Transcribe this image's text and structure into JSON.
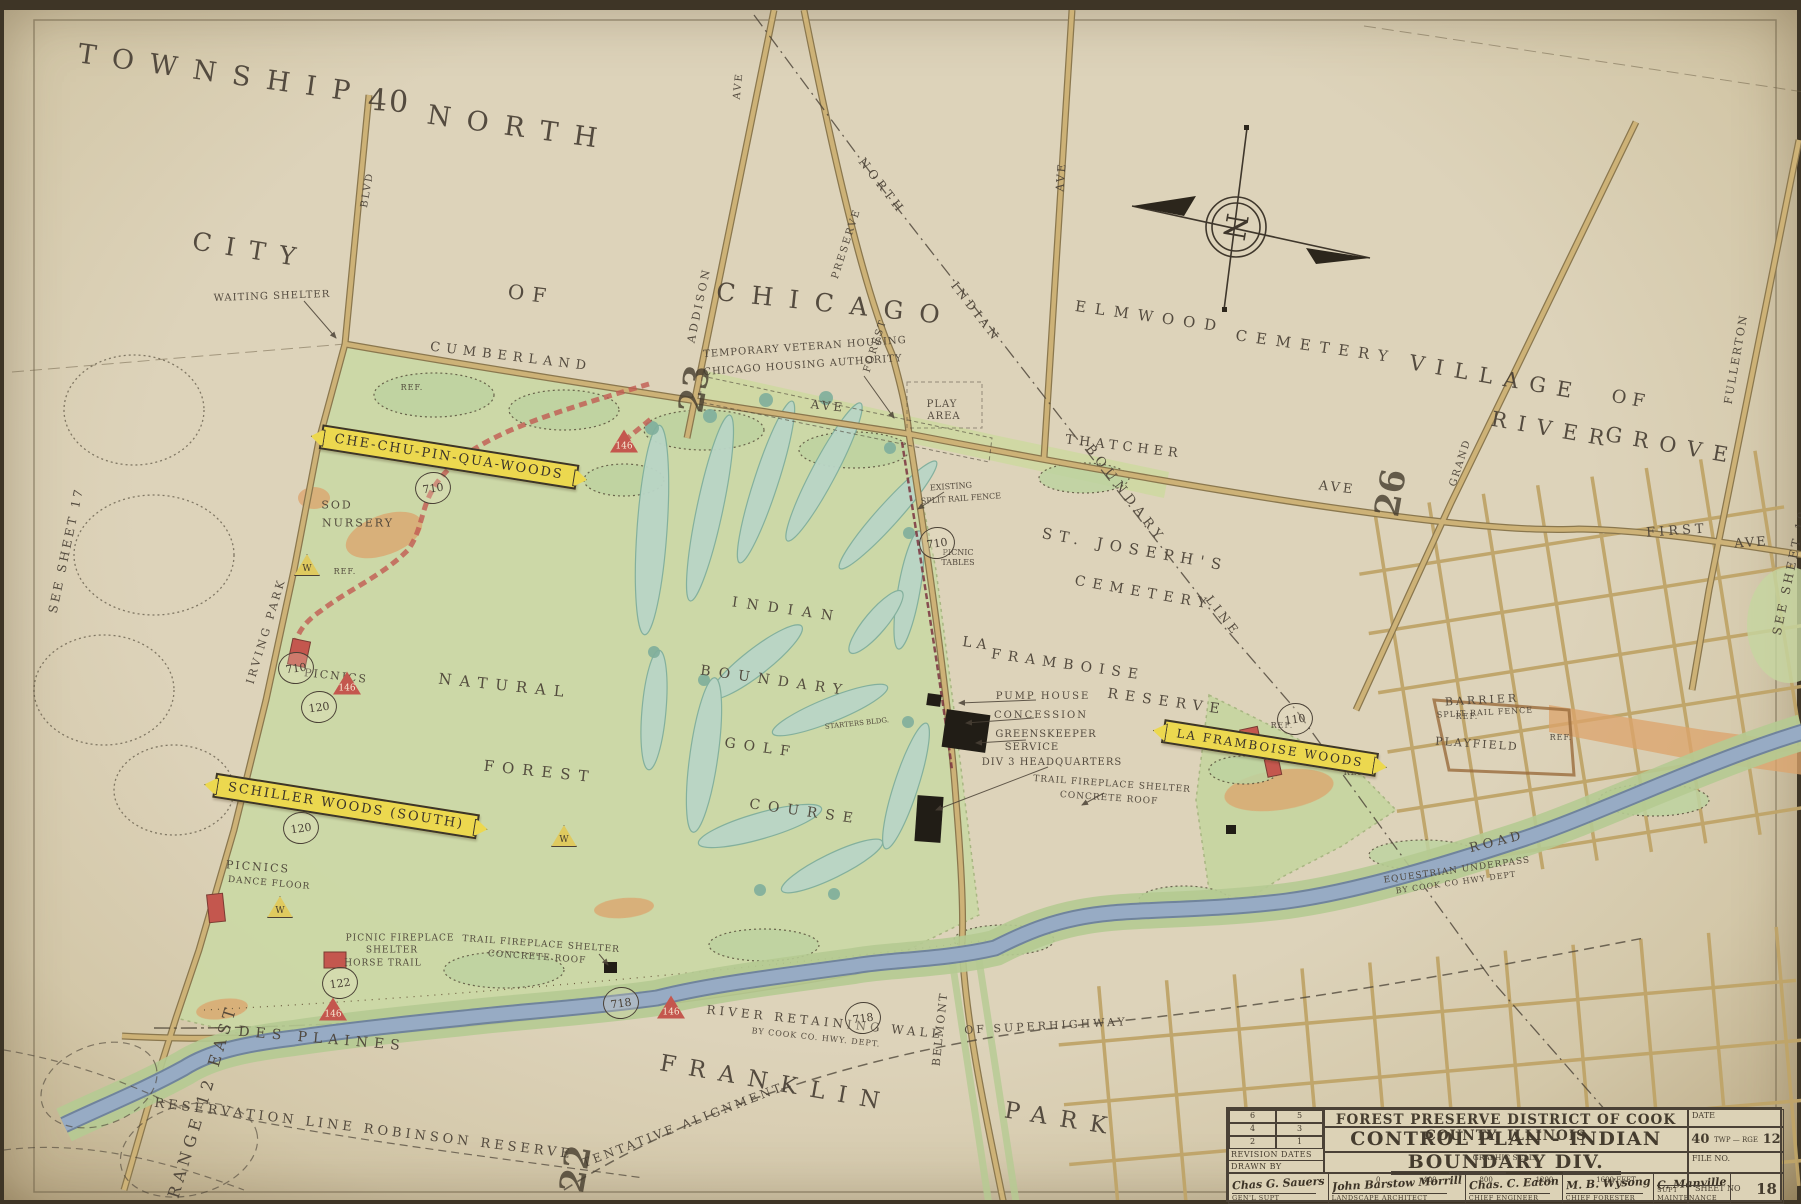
{
  "colors": {
    "paper": "#ddd3ba",
    "ink": "#4a4136",
    "road": "#c9ae74",
    "roadEdge": "#8a774e",
    "green": "#c8d8a4",
    "golf": "#b9d5c6",
    "river": "#97abc4",
    "banner": "#ecd84f",
    "red": "#c4574e",
    "trail": "#c25b52",
    "orange": "#dca36b"
  },
  "compass": {
    "letter": "N"
  },
  "banners": [
    {
      "t": "CHE-CHU-PIN-QUA-WOODS",
      "x": 445,
      "y": 447,
      "r": 9,
      "s": 13
    },
    {
      "t": "SCHILLER WOODS (SOUTH)",
      "x": 342,
      "y": 796,
      "r": 9,
      "s": 13
    },
    {
      "t": "LA FRAMBOISE WOODS",
      "x": 1266,
      "y": 738,
      "r": 9,
      "s": 12
    }
  ],
  "circles": [
    {
      "n": "710",
      "x": 429,
      "y": 478
    },
    {
      "n": "710",
      "x": 933,
      "y": 533
    },
    {
      "n": "710",
      "x": 292,
      "y": 658
    },
    {
      "n": "120",
      "x": 315,
      "y": 697
    },
    {
      "n": "120",
      "x": 297,
      "y": 818
    },
    {
      "n": "122",
      "x": 336,
      "y": 973
    },
    {
      "n": "718",
      "x": 617,
      "y": 993
    },
    {
      "n": "718",
      "x": 859,
      "y": 1008
    },
    {
      "n": "110",
      "x": 1291,
      "y": 709
    }
  ],
  "triangles": [
    {
      "n": "146",
      "x": 620,
      "y": 431,
      "k": "red"
    },
    {
      "n": "146",
      "x": 343,
      "y": 673,
      "k": "red"
    },
    {
      "n": "146",
      "x": 667,
      "y": 997,
      "k": "red"
    },
    {
      "n": "146",
      "x": 329,
      "y": 999,
      "k": "red"
    },
    {
      "n": "W",
      "x": 303,
      "y": 555,
      "k": "yel"
    },
    {
      "n": "W",
      "x": 276,
      "y": 897,
      "k": "yel"
    },
    {
      "n": "W",
      "x": 560,
      "y": 826,
      "k": "yel"
    }
  ],
  "labels": [
    {
      "t": "TOWNSHIP",
      "x": 218,
      "y": 64,
      "r": 8,
      "s": 27,
      "ls": 16
    },
    {
      "t": "40",
      "x": 385,
      "y": 92,
      "r": 4,
      "s": 30,
      "ls": 2
    },
    {
      "t": "NORTH",
      "x": 516,
      "y": 118,
      "r": 8,
      "s": 27,
      "ls": 16
    },
    {
      "t": "CITY",
      "x": 247,
      "y": 240,
      "r": 9,
      "s": 25,
      "ls": 14
    },
    {
      "t": "OF",
      "x": 527,
      "y": 284,
      "r": 7,
      "s": 20,
      "ls": 8
    },
    {
      "t": "CHICAGO",
      "x": 832,
      "y": 294,
      "r": 6,
      "s": 25,
      "ls": 16
    },
    {
      "t": "VILLAGE",
      "x": 1492,
      "y": 368,
      "r": 10,
      "s": 21,
      "ls": 11
    },
    {
      "t": "OF",
      "x": 1627,
      "y": 390,
      "r": 10,
      "s": 18,
      "ls": 6
    },
    {
      "t": "RIVER",
      "x": 1549,
      "y": 420,
      "r": 10,
      "s": 21,
      "ls": 11
    },
    {
      "t": "GROVE",
      "x": 1668,
      "y": 436,
      "r": 10,
      "s": 21,
      "ls": 11
    },
    {
      "t": "ELMWOOD",
      "x": 1146,
      "y": 307,
      "r": 8,
      "s": 15,
      "ls": 9
    },
    {
      "t": "CEMETERY",
      "x": 1312,
      "y": 337,
      "r": 8,
      "s": 15,
      "ls": 9
    },
    {
      "t": "FRANKLIN",
      "x": 772,
      "y": 1074,
      "r": 10,
      "s": 23,
      "ls": 13
    },
    {
      "t": "PARK",
      "x": 1058,
      "y": 1110,
      "r": 9,
      "s": 23,
      "ls": 13
    },
    {
      "t": "ST. JOSEPH'S",
      "x": 1131,
      "y": 540,
      "r": 10,
      "s": 15,
      "ls": 7
    },
    {
      "t": "CEMETERY",
      "x": 1140,
      "y": 583,
      "r": 10,
      "s": 14,
      "ls": 7
    },
    {
      "t": "BOUNDARY",
      "x": 1121,
      "y": 484,
      "r": 52,
      "s": 13,
      "ls": 5
    },
    {
      "t": "LINE",
      "x": 1219,
      "y": 606,
      "r": 52,
      "s": 12,
      "ls": 4
    },
    {
      "t": "LA",
      "x": 973,
      "y": 634,
      "r": 8,
      "s": 14,
      "ls": 5
    },
    {
      "t": "FRAMBOISE",
      "x": 1064,
      "y": 655,
      "r": 8,
      "s": 14,
      "ls": 7
    },
    {
      "t": "RESERVE",
      "x": 1163,
      "y": 692,
      "r": 8,
      "s": 14,
      "ls": 7
    },
    {
      "t": "NATURAL",
      "x": 501,
      "y": 676,
      "r": 6,
      "s": 15,
      "ls": 8
    },
    {
      "t": "FOREST",
      "x": 536,
      "y": 762,
      "r": 6,
      "s": 15,
      "ls": 8
    },
    {
      "t": "INDIAN",
      "x": 783,
      "y": 600,
      "r": 8,
      "s": 14,
      "ls": 9
    },
    {
      "t": "BOUNDARY",
      "x": 771,
      "y": 671,
      "r": 8,
      "s": 14,
      "ls": 8
    },
    {
      "t": "GOLF",
      "x": 757,
      "y": 738,
      "r": 8,
      "s": 14,
      "ls": 8
    },
    {
      "t": "COURSE",
      "x": 801,
      "y": 802,
      "r": 8,
      "s": 14,
      "ls": 8
    },
    {
      "t": "DES PLAINES",
      "x": 318,
      "y": 1029,
      "r": 5,
      "s": 14,
      "ls": 6
    },
    {
      "t": "RANGE 12 EAST",
      "x": 199,
      "y": 1091,
      "r": -73,
      "s": 16,
      "ls": 5
    },
    {
      "t": "RESERVATION LINE ROBINSON RESERVE",
      "x": 360,
      "y": 1119,
      "r": 7,
      "s": 13,
      "ls": 4
    },
    {
      "t": "NORTH",
      "x": 878,
      "y": 176,
      "r": 52,
      "s": 12,
      "ls": 4
    },
    {
      "t": "INDIAN",
      "x": 972,
      "y": 302,
      "r": 52,
      "s": 12,
      "ls": 4
    },
    {
      "t": "CUMBERLAND",
      "x": 507,
      "y": 347,
      "r": 7,
      "s": 13,
      "ls": 6
    },
    {
      "t": "AVE",
      "x": 824,
      "y": 396,
      "r": 6,
      "s": 12,
      "ls": 3
    },
    {
      "t": "THATCHER",
      "x": 1120,
      "y": 437,
      "r": 7,
      "s": 13,
      "ls": 5
    },
    {
      "t": "AVE",
      "x": 1333,
      "y": 478,
      "r": 7,
      "s": 13,
      "ls": 3
    },
    {
      "t": "ADDISON",
      "x": 695,
      "y": 295,
      "r": -78,
      "s": 11,
      "ls": 3
    },
    {
      "t": "AVE",
      "x": 735,
      "y": 76,
      "r": -84,
      "s": 10,
      "ls": 2
    },
    {
      "t": "BLVD",
      "x": 364,
      "y": 180,
      "r": -80,
      "s": 10,
      "ls": 2
    },
    {
      "t": "AVE",
      "x": 1057,
      "y": 167,
      "r": -85,
      "s": 11,
      "ls": 2
    },
    {
      "t": "PRESERVE",
      "x": 843,
      "y": 234,
      "r": -72,
      "s": 10,
      "ls": 2
    },
    {
      "t": "FOREST",
      "x": 872,
      "y": 336,
      "r": -72,
      "s": 10,
      "ls": 2
    },
    {
      "t": "IRVING PARK",
      "x": 262,
      "y": 621,
      "r": -73,
      "s": 11,
      "ls": 3
    },
    {
      "t": "GRAND",
      "x": 1457,
      "y": 453,
      "r": -72,
      "s": 10,
      "ls": 2
    },
    {
      "t": "FULLERTON",
      "x": 1732,
      "y": 349,
      "r": -80,
      "s": 11,
      "ls": 2
    },
    {
      "t": "FIRST",
      "x": 1673,
      "y": 521,
      "r": -4,
      "s": 13,
      "ls": 4
    },
    {
      "t": "AVE",
      "x": 1747,
      "y": 533,
      "r": -4,
      "s": 13,
      "ls": 2
    },
    {
      "t": "BELMONT",
      "x": 936,
      "y": 1019,
      "r": -84,
      "s": 11,
      "ls": 2
    },
    {
      "t": "ROAD",
      "x": 1493,
      "y": 832,
      "r": -14,
      "s": 13,
      "ls": 4
    },
    {
      "t": "OF SUPERHIGHWAY",
      "x": 1042,
      "y": 1016,
      "r": -3,
      "s": 11,
      "ls": 3
    },
    {
      "t": "TENTATIVE ALIGNMENT",
      "x": 679,
      "y": 1115,
      "r": -21,
      "s": 12,
      "ls": 3
    },
    {
      "t": "RIVER RETAINING WALL",
      "x": 821,
      "y": 1012,
      "r": 6,
      "s": 12,
      "ls": 4
    },
    {
      "t": "BY COOK CO. HWY. DEPT.",
      "x": 812,
      "y": 1028,
      "r": 6,
      "s": 8,
      "ls": 1
    },
    {
      "t": "EQUESTRIAN UNDERPASS",
      "x": 1453,
      "y": 861,
      "r": -8,
      "s": 9,
      "ls": 1
    },
    {
      "t": "BY COOK CO HWY DEPT",
      "x": 1452,
      "y": 873,
      "r": -8,
      "s": 8,
      "ls": 1
    },
    {
      "t": "WAITING SHELTER",
      "x": 268,
      "y": 287,
      "r": -2,
      "s": 10,
      "ls": 1
    },
    {
      "t": "TEMPORARY VETERAN HOUSING",
      "x": 801,
      "y": 338,
      "r": -4,
      "s": 10,
      "ls": 1
    },
    {
      "t": "CHICAGO HOUSING AUTHORITY",
      "x": 799,
      "y": 356,
      "r": -4,
      "s": 10,
      "ls": 1
    },
    {
      "t": "PLAY",
      "x": 938,
      "y": 395,
      "r": 0,
      "s": 10,
      "ls": 1
    },
    {
      "t": "AREA",
      "x": 940,
      "y": 407,
      "r": 0,
      "s": 10,
      "ls": 1
    },
    {
      "t": "SOD",
      "x": 333,
      "y": 495,
      "r": 0,
      "s": 11,
      "ls": 2
    },
    {
      "t": "NURSERY",
      "x": 354,
      "y": 513,
      "r": 0,
      "s": 11,
      "ls": 2
    },
    {
      "t": "PICNICS",
      "x": 332,
      "y": 666,
      "r": 6,
      "s": 11,
      "ls": 2
    },
    {
      "t": "PICNICS",
      "x": 254,
      "y": 857,
      "r": 4,
      "s": 11,
      "ls": 2
    },
    {
      "t": "DANCE FLOOR",
      "x": 265,
      "y": 874,
      "r": 5,
      "s": 9,
      "ls": 1
    },
    {
      "t": "PICNIC FIREPLACE",
      "x": 396,
      "y": 929,
      "r": 0,
      "s": 9,
      "ls": 1
    },
    {
      "t": "SHELTER",
      "x": 388,
      "y": 941,
      "r": 0,
      "s": 9,
      "ls": 1
    },
    {
      "t": "HORSE TRAIL",
      "x": 379,
      "y": 954,
      "r": 0,
      "s": 9,
      "ls": 1
    },
    {
      "t": "TRAIL FIREPLACE SHELTER",
      "x": 537,
      "y": 935,
      "r": 4,
      "s": 9,
      "ls": 1
    },
    {
      "t": "CONCRETE ROOF",
      "x": 533,
      "y": 948,
      "r": 4,
      "s": 9,
      "ls": 1
    },
    {
      "t": "TRAIL FIREPLACE SHELTER",
      "x": 1108,
      "y": 775,
      "r": 4,
      "s": 9,
      "ls": 1
    },
    {
      "t": "CONCRETE ROOF",
      "x": 1105,
      "y": 789,
      "r": 4,
      "s": 9,
      "ls": 1
    },
    {
      "t": "PUMP HOUSE",
      "x": 1039,
      "y": 687,
      "r": 0,
      "s": 10,
      "ls": 2
    },
    {
      "t": "CONCESSION",
      "x": 1037,
      "y": 706,
      "r": 0,
      "s": 10,
      "ls": 2
    },
    {
      "t": "GREENSKEEPER",
      "x": 1042,
      "y": 725,
      "r": 0,
      "s": 10,
      "ls": 1
    },
    {
      "t": "SERVICE",
      "x": 1028,
      "y": 738,
      "r": 0,
      "s": 10,
      "ls": 1
    },
    {
      "t": "DIV 3 HEADQUARTERS",
      "x": 1048,
      "y": 753,
      "r": 0,
      "s": 10,
      "ls": 1
    },
    {
      "t": "STARTERS BLDG.",
      "x": 853,
      "y": 714,
      "r": -6,
      "s": 7,
      "ls": 0
    },
    {
      "t": "PICNIC",
      "x": 954,
      "y": 543,
      "r": 0,
      "s": 8,
      "ls": 0
    },
    {
      "t": "TABLES",
      "x": 954,
      "y": 553,
      "r": 0,
      "s": 8,
      "ls": 0
    },
    {
      "t": "EXISTING",
      "x": 947,
      "y": 477,
      "r": -4,
      "s": 8,
      "ls": 0
    },
    {
      "t": "SPLIT RAIL FENCE",
      "x": 957,
      "y": 489,
      "r": -4,
      "s": 8,
      "ls": 0
    },
    {
      "t": "BARRIER",
      "x": 1478,
      "y": 690,
      "r": -3,
      "s": 11,
      "ls": 3
    },
    {
      "t": "SPLIT RAIL FENCE",
      "x": 1481,
      "y": 703,
      "r": -3,
      "s": 8,
      "ls": 1
    },
    {
      "t": "PLAYFIELD",
      "x": 1473,
      "y": 734,
      "r": 4,
      "s": 11,
      "ls": 2
    },
    {
      "t": "REF.",
      "x": 408,
      "y": 378,
      "r": 0,
      "s": 8,
      "ls": 1
    },
    {
      "t": "REF.",
      "x": 341,
      "y": 562,
      "r": 0,
      "s": 8,
      "ls": 1
    },
    {
      "t": "REF.",
      "x": 1278,
      "y": 716,
      "r": 0,
      "s": 8,
      "ls": 1
    },
    {
      "t": "REF.",
      "x": 1351,
      "y": 763,
      "r": 0,
      "s": 8,
      "ls": 1
    },
    {
      "t": "REF.",
      "x": 1463,
      "y": 707,
      "r": 0,
      "s": 8,
      "ls": 1
    },
    {
      "t": "REF.",
      "x": 1557,
      "y": 728,
      "r": 0,
      "s": 8,
      "ls": 1
    },
    {
      "t": "SEE  SHEET  17",
      "x": 62,
      "y": 540,
      "r": -78,
      "s": 12,
      "ls": 3
    },
    {
      "t": "SEE  SHEET  19",
      "x": 1786,
      "y": 562,
      "r": -78,
      "s": 12,
      "ls": 3
    },
    {
      "t": "SHEET 18",
      "x": 1694,
      "y": 1184,
      "r": -2,
      "s": 14,
      "ls": 1,
      "c": "hand"
    },
    {
      "t": "23",
      "x": 691,
      "y": 379,
      "r": -80,
      "s": 34,
      "ls": 0,
      "c": "sec"
    },
    {
      "t": "26",
      "x": 1387,
      "y": 483,
      "r": -80,
      "s": 34,
      "ls": 0,
      "c": "sec"
    },
    {
      "t": "22",
      "x": 572,
      "y": 1159,
      "r": -80,
      "s": 34,
      "ls": 0,
      "c": "sec"
    }
  ],
  "title_block": {
    "agency": "FOREST PRESERVE DISTRICT OF COOK COUNTY, ILLINOIS",
    "title": "CONTROL PLAN - INDIAN BOUNDARY DIV.",
    "graphic_scale_label": "GRAPHIC SCALE",
    "scale_ticks": [
      "0",
      "400",
      "800",
      "1200",
      "1600 FEET"
    ],
    "revision_numbers": [
      "6",
      "5",
      "4",
      "3",
      "2",
      "1"
    ],
    "revision_label": "REVISION DATES",
    "drawn_by_label": "DRAWN BY",
    "date_label": "DATE",
    "twp_value": "40",
    "rge_value": "12",
    "twp_rge_label": "TWP — RGE",
    "file_label": "FILE NO.",
    "sheet_label": "SHEET NO",
    "sheet_no": "18",
    "signatures": [
      {
        "name": "Chas G. Sauers",
        "role": "GEN'L SUPT"
      },
      {
        "name": "John Barstow Morrill",
        "role": "LANDSCAPE ARCHITECT"
      },
      {
        "name": "Chas. C. Eaton",
        "role": "CHIEF ENGINEER"
      },
      {
        "name": "M. B. Wysong",
        "role": "CHIEF FORESTER"
      },
      {
        "name": "C. Manville",
        "role": "SUPT MAINTENANCE"
      }
    ]
  }
}
